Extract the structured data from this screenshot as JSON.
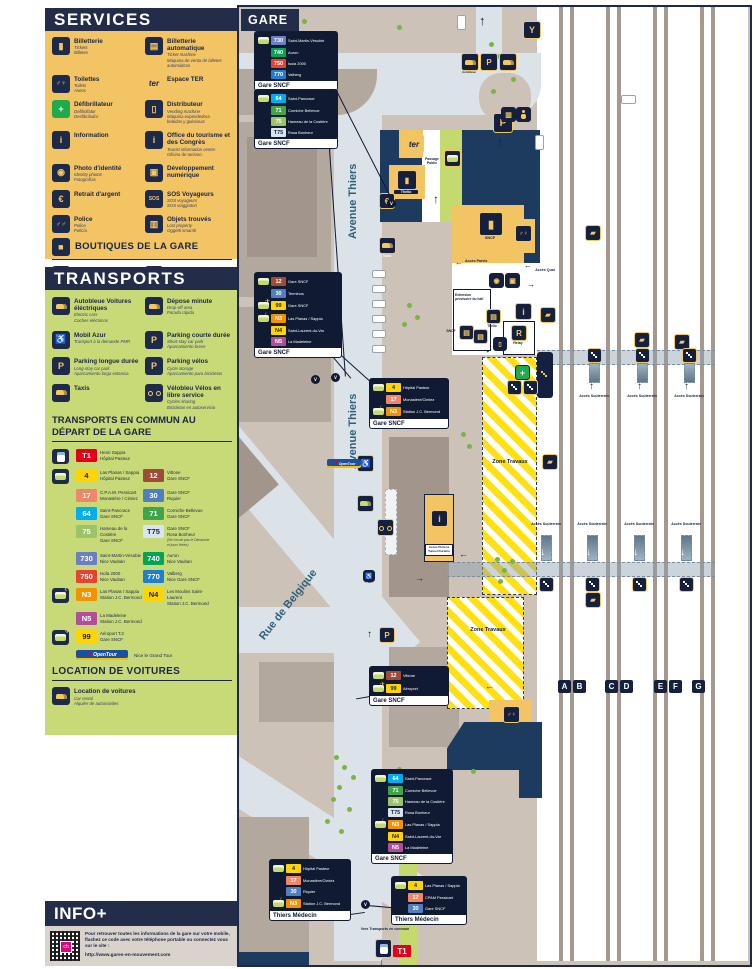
{
  "colors": {
    "navy": "#232c49",
    "panel_yellow": "#f2c463",
    "panel_green": "#c8da78",
    "info_gray": "#d9d3cc",
    "map_ground": "#ccc2b8",
    "map_road": "#dce3e8",
    "building_navy": "#1d3a5f",
    "hatch_yellow": "#ffe011"
  },
  "line_colors": {
    "T1": {
      "bg": "#e2001a",
      "fg": "#ffffff"
    },
    "4": {
      "bg": "#ffd400",
      "fg": "#1b2547"
    },
    "12": {
      "bg": "#9f4b36",
      "fg": "#ffffff"
    },
    "17": {
      "bg": "#f0876b",
      "fg": "#ffffff"
    },
    "30": {
      "bg": "#4f7fc0",
      "fg": "#ffffff"
    },
    "64": {
      "bg": "#00aeef",
      "fg": "#ffffff"
    },
    "71": {
      "bg": "#3fa44a",
      "fg": "#ffffff"
    },
    "75": {
      "bg": "#9bc46a",
      "fg": "#ffffff"
    },
    "T75": {
      "bg": "#d9e4f0",
      "fg": "#1b2547"
    },
    "730": {
      "bg": "#6b7fc2",
      "fg": "#ffffff"
    },
    "740": {
      "bg": "#00a651",
      "fg": "#ffffff"
    },
    "750": {
      "bg": "#e8432e",
      "fg": "#ffffff"
    },
    "770": {
      "bg": "#1e7fd0",
      "fg": "#ffffff"
    },
    "N3": {
      "bg": "#f39200",
      "fg": "#ffffff"
    },
    "N4": {
      "bg": "#ffd400",
      "fg": "#1b2547"
    },
    "N5": {
      "bg": "#b04e98",
      "fg": "#ffffff"
    },
    "99": {
      "bg": "#ffd400",
      "fg": "#1b2547"
    }
  },
  "services": {
    "title": "SERVICES",
    "items": [
      {
        "icon": "ticket",
        "name": "Billetterie",
        "subs": [
          "Tickets",
          "Billetes"
        ]
      },
      {
        "icon": "ticket-machine",
        "name": "Billetterie automatique",
        "subs": [
          "Ticket machine",
          "Máquina de venta de billetes automáticos"
        ]
      },
      {
        "icon": "toilets",
        "name": "Toilettes",
        "subs": [
          "Toilets",
          "Aseos"
        ]
      },
      {
        "icon": "ter",
        "name": "Espace TER",
        "subs": []
      },
      {
        "icon": "defib",
        "name": "Défibrillateur",
        "subs": [
          "Defibrillator",
          "Desfibrilador"
        ]
      },
      {
        "icon": "vending",
        "name": "Distributeur",
        "subs": [
          "Vending machine",
          "Máquina expendedora",
          "bebidas y golosinas"
        ]
      },
      {
        "icon": "info",
        "name": "Information",
        "subs": []
      },
      {
        "icon": "tourism",
        "name": "Office du tourisme et des Congrès",
        "subs": [
          "Tourist information center",
          "Oficina de turismo"
        ]
      },
      {
        "icon": "photo",
        "name": "Photo d'identité",
        "subs": [
          "Identity photos",
          "Fotografías"
        ]
      },
      {
        "icon": "digital",
        "name": "Développement numérique",
        "subs": []
      },
      {
        "icon": "cash",
        "name": "Retrait d'argent",
        "subs": []
      },
      {
        "icon": "sos",
        "name": "SOS Voyageurs",
        "subs": [
          "SOS voyageurs",
          "SOS viaggiatori"
        ]
      },
      {
        "icon": "police",
        "name": "Police",
        "subs": [
          "Police",
          "Policía"
        ]
      },
      {
        "icon": "lost",
        "name": "Objets trouvés",
        "subs": [
          "Lost property",
          "Oggetti smarriti"
        ]
      }
    ],
    "boutiques_title": "BOUTIQUES DE LA GARE",
    "shops": [
      {
        "icon": "paul",
        "name": "PAUL"
      },
      {
        "icon": "relay",
        "name": "Relay"
      }
    ]
  },
  "transports": {
    "title": "TRANSPORTS",
    "items": [
      {
        "icon": "car",
        "name": "Autobleue Voitures éléctriques",
        "subs": [
          "Electric cars",
          "Coches eléctricos"
        ]
      },
      {
        "icon": "drop",
        "name": "Dépose minute",
        "subs": [
          "Drop-off area",
          "Parada rápida"
        ]
      },
      {
        "icon": "pmr",
        "name": "Mobil Azur",
        "subs": [
          "Transport à la demande PMR"
        ]
      },
      {
        "icon": "pshort",
        "name": "Parking courte durée",
        "subs": [
          "Short-stay car park",
          "Aparcamiento breve"
        ]
      },
      {
        "icon": "plong",
        "name": "Parking longue durée",
        "subs": [
          "Long-stay car park",
          "Aparcamiento larga estancia"
        ]
      },
      {
        "icon": "pbike",
        "name": "Parking vélos",
        "subs": [
          "Cycle storage",
          "Aparcamiento para bicicletas"
        ]
      },
      {
        "icon": "taxi",
        "name": "Taxis",
        "subs": []
      },
      {
        "icon": "bike",
        "name": "Vélobleu Vélos en libre service",
        "subs": [
          "Cycles sharing",
          "Bicicletas en autoservicio"
        ]
      }
    ],
    "commun_title": "TRANSPORTS EN COMMUN AU DÉPART DE LA GARE",
    "line_rows": [
      {
        "slot": "tram",
        "cells": [
          {
            "badge": "T1",
            "d1": "Henri Sappia",
            "d2": "Hôpital Pasteur"
          }
        ]
      },
      {
        "slot": "bus",
        "cells": [
          {
            "badge": "4",
            "d1": "Las Planas / Sappia",
            "d2": "Hôpital Pasteur"
          },
          {
            "badge": "12",
            "d1": "Vittone",
            "d2": "Gare SNCF"
          }
        ]
      },
      {
        "slot": "",
        "cells": [
          {
            "badge": "17",
            "d1": "C.P.A.M. Pessicart",
            "d2": "Monastère / Cimiez"
          },
          {
            "badge": "30",
            "d1": "Gare SNCF",
            "d2": "Riquier"
          }
        ]
      },
      {
        "slot": "",
        "cells": [
          {
            "badge": "64",
            "d1": "Saint-Pancrace",
            "d2": "Gare SNCF"
          },
          {
            "badge": "71",
            "d1": "Corniche Bellevue",
            "d2": "Gare SNCF"
          }
        ]
      },
      {
        "slot": "",
        "cells": [
          {
            "badge": "75",
            "d1": "Hameau de la Costière",
            "d2": "Gare SNCF"
          },
          {
            "badge": "T75",
            "d1": "Gare SNCF",
            "d2": "Rosa Bonheur",
            "note": "(Ne circule pas le Dimanche et jours fériés)"
          }
        ]
      },
      {
        "slot": "",
        "cells": [
          {
            "badge": "730",
            "d1": "Saint-Martin-Vésubie",
            "d2": "Nice Vauban"
          },
          {
            "badge": "740",
            "d1": "Auron",
            "d2": "Nice Vauban"
          }
        ]
      },
      {
        "slot": "",
        "cells": [
          {
            "badge": "750",
            "d1": "Isola 2000",
            "d2": "Nice Vauban"
          },
          {
            "badge": "770",
            "d1": "Valberg",
            "d2": "Nice Gare SNCF"
          }
        ]
      },
      {
        "slot": "night",
        "cells": [
          {
            "badge": "N3",
            "d1": "Las Planas / Sappia",
            "d2": "Station J.C. Bermond"
          },
          {
            "badge": "N4",
            "d1": "Les Moulins Saint-Laurent",
            "d2": "Station J.C. Bermond"
          }
        ]
      },
      {
        "slot": "",
        "cells": [
          {
            "badge": "N5",
            "d1": "La Madeleine",
            "d2": "Station J.C. Bermond"
          }
        ]
      },
      {
        "slot": "airbus",
        "cells": [
          {
            "badge": "99",
            "d1": "Aéroport T.2",
            "d2": "Gare SNCF"
          }
        ]
      }
    ],
    "opentour": {
      "logo": "OpenTour",
      "label": "Nice le Grand Tour"
    },
    "location_title": "LOCATION DE VOITURES",
    "location_item": {
      "icon": "car",
      "name": "Location de voitures",
      "subs": [
        "Car rental",
        "Alquiler de automóviles"
      ]
    }
  },
  "info": {
    "title": "INFO+",
    "text": "Pour retrouver toutes les informations de la gare sur votre mobile, flashez ce code avec votre téléphone portable ou connectez vous sur le site :",
    "url": "http://www.gares-en-mouvement.com",
    "qr_center": "ch"
  },
  "map": {
    "title": "GARE",
    "street_avenue": "Avenue Thiers",
    "street_belgique": "Rue de Belgique",
    "zone_label": "Zone Travaux",
    "labels": {
      "souterrain": "Accès Souterrain",
      "quai": "Accès Quai",
      "parvis": "Accès Parvis",
      "passage": "Passage Public",
      "extension": "Extension provisoire du hall",
      "vers_tc": "Vers Transports en commun",
      "gc": "Gares & Connexions",
      "tunnel": "Accès Piétons Tunnel Durante",
      "pmr": "PMR"
    },
    "poi": {
      "sncf": "SNCF",
      "thello": "Thello",
      "relay": "Relay",
      "taxis": "Taxis",
      "ter": "ter",
      "autobleue": "Autobleue",
      "t1": "T1",
      "y": "Y"
    },
    "platforms": [
      "A",
      "B",
      "C",
      "D",
      "E",
      "F",
      "G"
    ],
    "callouts": [
      {
        "x": 16,
        "y": 25,
        "w": 76,
        "footer": "Gare SNCF",
        "rows": [
          {
            "icon": "bus",
            "badge": "730",
            "label": "Saint-Martin-Vésubie"
          },
          {
            "icon": "",
            "badge": "740",
            "label": "Auron"
          },
          {
            "icon": "",
            "badge": "750",
            "label": "Isola 2000"
          },
          {
            "icon": "",
            "badge": "770",
            "label": "Valberg"
          }
        ]
      },
      {
        "x": 16,
        "y": 83,
        "w": 76,
        "footer": "Gare SNCF",
        "rows": [
          {
            "icon": "bus",
            "badge": "64",
            "label": "Saint-Pancrace"
          },
          {
            "icon": "",
            "badge": "71",
            "label": "Corniche Bellevue"
          },
          {
            "icon": "",
            "badge": "75",
            "label": "Hameau de la Costière"
          },
          {
            "icon": "",
            "badge": "T75",
            "label": "Rosa Bonheur"
          }
        ]
      },
      {
        "x": 16,
        "y": 266,
        "w": 80,
        "footer": "Gare SNCF",
        "rows": [
          {
            "icon": "bus",
            "badge": "12",
            "label": "Gare SNCF"
          },
          {
            "icon": "",
            "badge": "30",
            "label": "Terminus"
          },
          {
            "icon": "airbus",
            "badge": "99",
            "label": "Gare SNCF"
          },
          {
            "icon": "night",
            "badge": "N3",
            "label": "Las Planas / Sappia"
          },
          {
            "icon": "",
            "badge": "N4",
            "label": "Saint-Laurent-du-Var"
          },
          {
            "icon": "",
            "badge": "N5",
            "label": "La Madeleine"
          }
        ]
      },
      {
        "x": 131,
        "y": 372,
        "w": 72,
        "footer": "Gare SNCF",
        "rows": [
          {
            "icon": "bus",
            "badge": "4",
            "label": "Hôpital Pasteur"
          },
          {
            "icon": "",
            "badge": "17",
            "label": "Monastère/Cimiez"
          },
          {
            "icon": "night",
            "badge": "N3",
            "label": "Station J.C. Bermond"
          }
        ]
      },
      {
        "x": 131,
        "y": 660,
        "w": 72,
        "footer": "Gare SNCF",
        "rows": [
          {
            "icon": "bus",
            "badge": "12",
            "label": "Vittone"
          },
          {
            "icon": "airbus",
            "badge": "99",
            "label": "Aéroport"
          }
        ]
      },
      {
        "x": 133,
        "y": 763,
        "w": 74,
        "footer": "Gare SNCF",
        "rows": [
          {
            "icon": "bus",
            "badge": "64",
            "label": "Saint-Pancrace"
          },
          {
            "icon": "",
            "badge": "71",
            "label": "Corniche Bellevue"
          },
          {
            "icon": "",
            "badge": "75",
            "label": "Hameau de la Costière"
          },
          {
            "icon": "",
            "badge": "T75",
            "label": "Rosa Bonheur"
          },
          {
            "icon": "night",
            "badge": "N3",
            "label": "Las Planas / Sappia"
          },
          {
            "icon": "",
            "badge": "N4",
            "label": "Saint-Laurent-du-Var"
          },
          {
            "icon": "",
            "badge": "N5",
            "label": "La Madeleine"
          }
        ]
      },
      {
        "x": 31,
        "y": 853,
        "w": 74,
        "footer": "Thiers Médecin",
        "rows": [
          {
            "icon": "bus",
            "badge": "4",
            "label": "Hôpital Pasteur"
          },
          {
            "icon": "",
            "badge": "17",
            "label": "Monastère/Cimiez"
          },
          {
            "icon": "",
            "badge": "30",
            "label": "Riquier"
          },
          {
            "icon": "night",
            "badge": "N3",
            "label": "Station J.C. Bermond"
          }
        ]
      },
      {
        "x": 153,
        "y": 870,
        "w": 68,
        "footer": "Thiers Médecin",
        "rows": [
          {
            "icon": "bus",
            "badge": "4",
            "label": "Las Planas / Sappia"
          },
          {
            "icon": "",
            "badge": "17",
            "label": "CPAM Pessicart"
          },
          {
            "icon": "",
            "badge": "30",
            "label": "Gare SNCF"
          }
        ]
      }
    ]
  }
}
